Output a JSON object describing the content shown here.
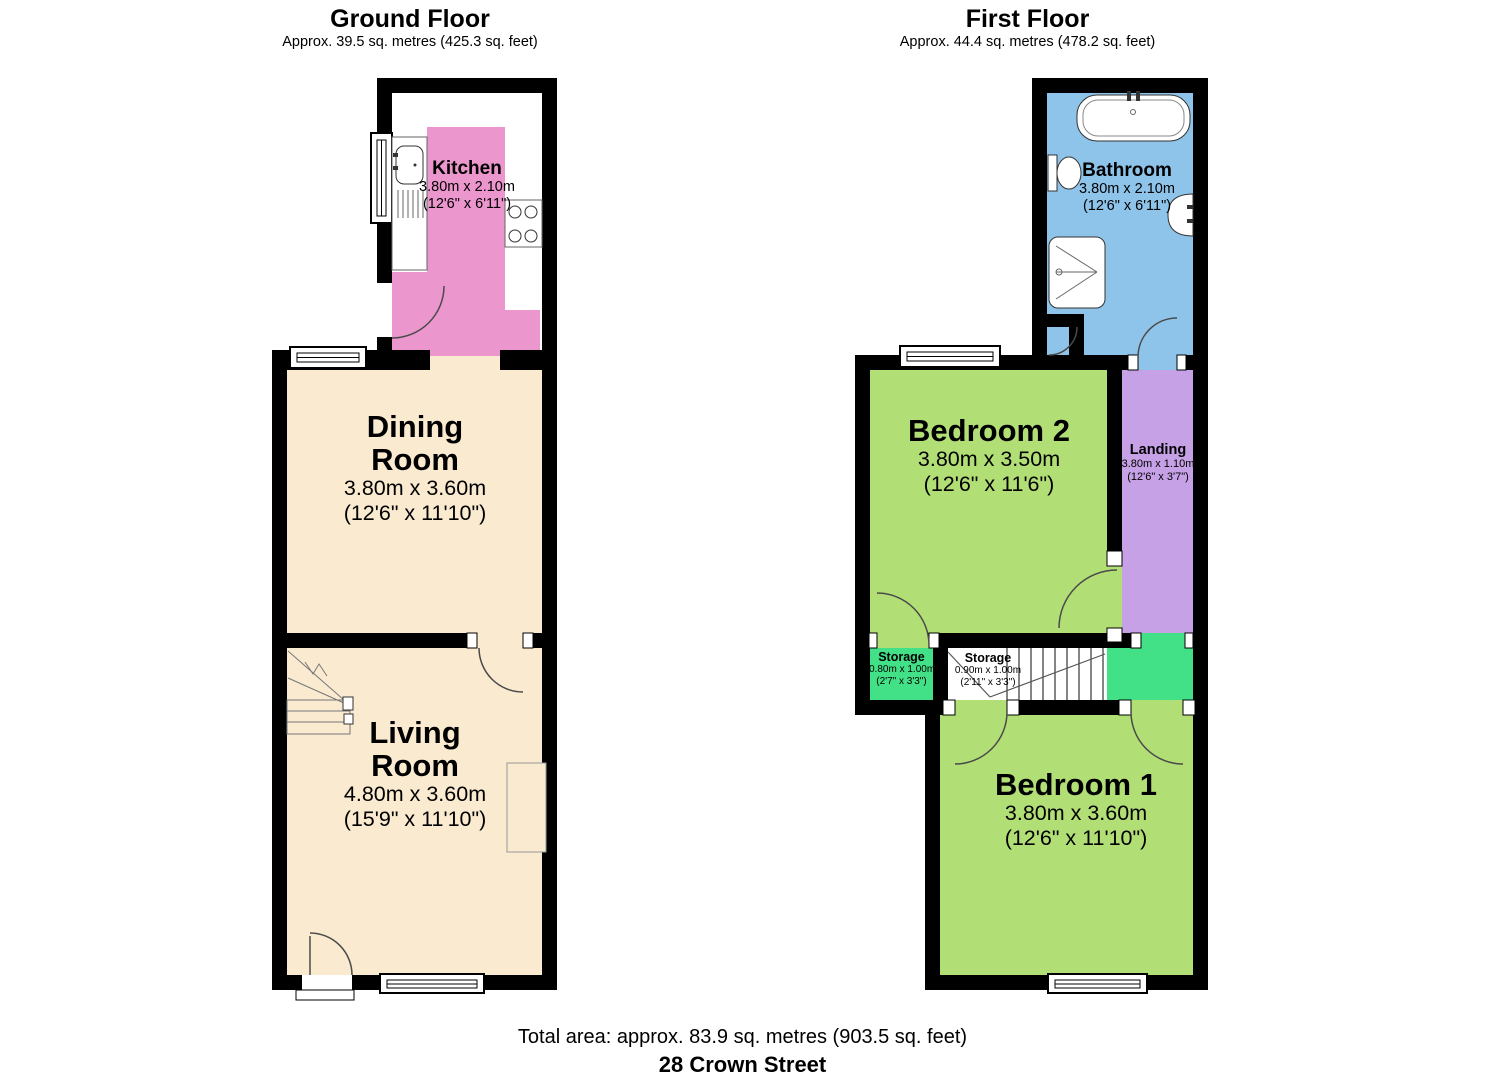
{
  "header": {
    "ground": {
      "title": "Ground Floor",
      "subtitle": "Approx. 39.5 sq. metres (425.3 sq. feet)"
    },
    "first": {
      "title": "First Floor",
      "subtitle": "Approx. 44.4 sq. metres (478.2 sq. feet)"
    }
  },
  "rooms": {
    "kitchen": {
      "name": "Kitchen",
      "metric": "3.80m x 2.10m",
      "imperial": "(12'6\" x 6'11\")"
    },
    "dining": {
      "name": "Dining",
      "name2": "Room",
      "metric": "3.80m x 3.60m",
      "imperial": "(12'6\" x 11'10\")"
    },
    "living": {
      "name": "Living",
      "name2": "Room",
      "metric": "4.80m x 3.60m",
      "imperial": "(15'9\" x 11'10\")"
    },
    "bathroom": {
      "name": "Bathroom",
      "metric": "3.80m x 2.10m",
      "imperial": "(12'6\" x 6'11\")"
    },
    "bedroom2": {
      "name": "Bedroom 2",
      "metric": "3.80m x 3.50m",
      "imperial": "(12'6\" x 11'6\")"
    },
    "landing": {
      "name": "Landing",
      "metric": "3.80m x 1.10m",
      "imperial": "(12'6\" x 3'7\")"
    },
    "storage1": {
      "name": "Storage",
      "metric": "0.80m x 1.00m",
      "imperial": "(2'7\" x 3'3\")"
    },
    "storage2": {
      "name": "Storage",
      "metric": "0.90m x 1.00m",
      "imperial": "(2'11\" x 3'3\")"
    },
    "bedroom1": {
      "name": "Bedroom 1",
      "metric": "3.80m x 3.60m",
      "imperial": "(12'6\" x 11'10\")"
    }
  },
  "footer": {
    "total_area": "Total area: approx. 83.9 sq. metres (903.5 sq. feet)",
    "address": "28 Crown Street"
  },
  "colors": {
    "wall": "#000000",
    "kitchen": "#EC96CE",
    "cream": "#F9EAD0",
    "bathroom": "#8FC4EA",
    "bedroom": "#B2DE76",
    "landing": "#C6A1E6",
    "storage": "#43E187",
    "white": "#FFFFFF"
  }
}
